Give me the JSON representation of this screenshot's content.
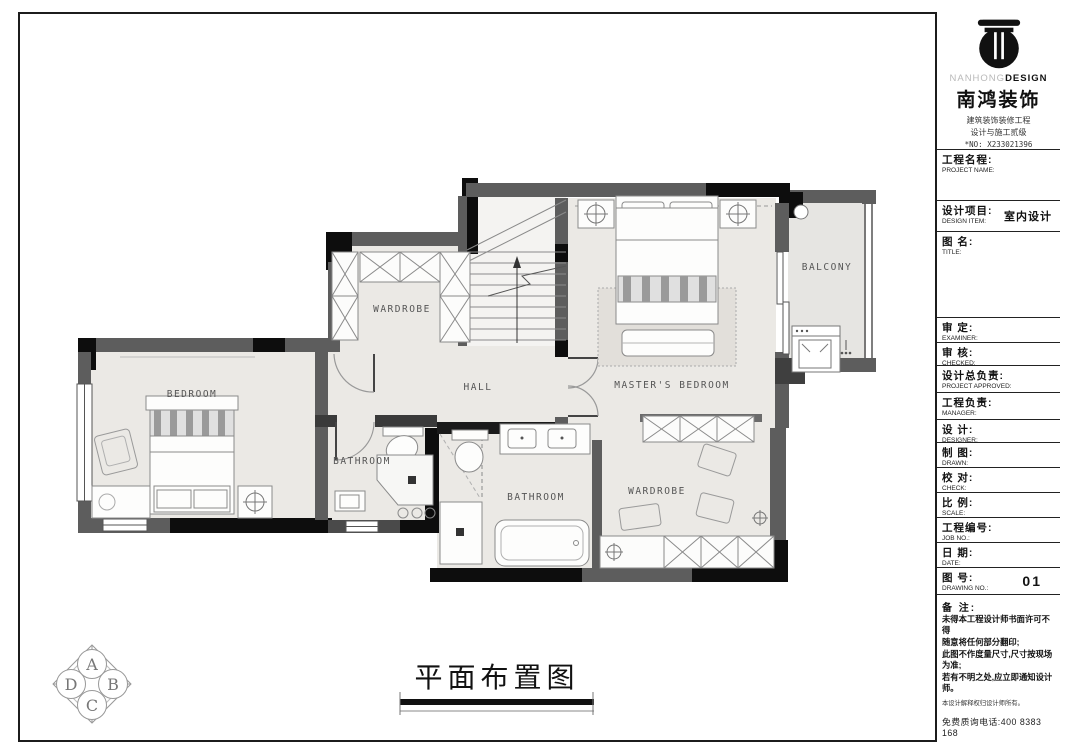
{
  "colors": {
    "wall": "#5d5d5d",
    "pier": "#0d0d0d",
    "floor": "#ebe9e5",
    "balcony_floor": "#e6e5e2",
    "line": "#8a8a8a"
  },
  "plan": {
    "labels": {
      "bedroom": "BEDROOM",
      "wardrobe_top": "WARDROBE",
      "hall": "HALL",
      "master_bedroom": "MASTER'S BEDROOM",
      "balcony": "BALCONY",
      "bathroom_small": "BATHROOM",
      "bathroom_master": "BATHROOM",
      "wardrobe_walkin": "WARDROBE"
    },
    "drawing_title": "平面布置图",
    "compass": {
      "top": "A",
      "right": "B",
      "bottom": "C",
      "left": "D"
    }
  },
  "title_block": {
    "logo": {
      "brand_en_light": "NANHONG",
      "brand_en_bold": "DESIGN",
      "brand_zh": "南鸿装饰",
      "cert_line1": "建筑装饰装修工程",
      "cert_line2": "设计与施工贰级",
      "cert_no": "*NO: X233021396"
    },
    "fields": [
      {
        "zh": "工程名程:",
        "en": "PROJECT NAME:",
        "value": ""
      },
      {
        "zh": "设计项目:",
        "en": "DESIGN ITEM:",
        "value": "室内设计"
      },
      {
        "zh": "图  名:",
        "en": "TITLE:",
        "value": ""
      },
      {
        "zh": "审   定:",
        "en": "EXAMINER:",
        "value": ""
      },
      {
        "zh": "审   核:",
        "en": "CHECKED:",
        "value": ""
      },
      {
        "zh": "设计总负责:",
        "en": "PROJECT APPROVED:",
        "value": ""
      },
      {
        "zh": "工程负责:",
        "en": "MANAGER:",
        "value": ""
      },
      {
        "zh": "设   计:",
        "en": "DESIGNER:",
        "value": ""
      },
      {
        "zh": "制   图:",
        "en": "DRAWN:",
        "value": ""
      },
      {
        "zh": "校   对:",
        "en": "CHECK:",
        "value": ""
      },
      {
        "zh": "比   例:",
        "en": "SCALE:",
        "value": ""
      },
      {
        "zh": "工程编号:",
        "en": "JOB NO.:",
        "value": ""
      },
      {
        "zh": "日   期:",
        "en": "DATE:",
        "value": ""
      },
      {
        "zh": "图   号:",
        "en": "DRAWING NO.:",
        "value": "01"
      }
    ],
    "notes": {
      "title": "备 注:",
      "lines": [
        "未得本工程设计师书面许可不得",
        "随意将任何部分翻印;",
        "此图不作度量尺寸,尺寸按现场",
        "为准;",
        "若有不明之处,应立即通知设计",
        "师。"
      ],
      "disclaimer": "本设计解释权归设计师所有。",
      "phone": "免费质询电话:400 8383 168"
    }
  }
}
